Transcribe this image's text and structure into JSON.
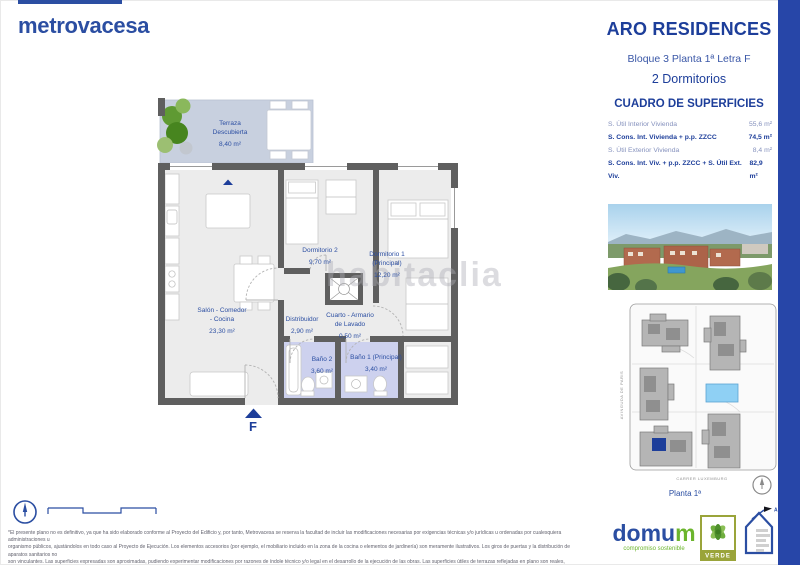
{
  "brand": {
    "name": "metrovacesa"
  },
  "header": {
    "title": "ARO RESIDENCES",
    "block_line": "Bloque 3 Planta 1ª Letra F",
    "type_line": "2 Dormitorios"
  },
  "surfaces": {
    "title": "CUADRO DE SUPERFICIES",
    "rows": [
      {
        "label": "S. Útil Interior Vivienda",
        "value": "55,6 m²"
      },
      {
        "label": "S. Cons. Int. Vivienda + p.p. ZZCC",
        "value": "74,5 m²"
      },
      {
        "label": "S. Útil Exterior Vivienda",
        "value": "8,4 m²"
      },
      {
        "label": "S. Cons. Int. Viv. + p.p. ZZCC + S. Útil Ext. Viv.",
        "value": "82,9 m²"
      }
    ]
  },
  "floorplan": {
    "watermark": "habitaclia",
    "entrance_label": "F",
    "rooms": [
      {
        "line1": "Terraza",
        "line2": "Descubierta",
        "area": "8,40 m²"
      },
      {
        "line1": "Salón - Comedor",
        "line2": "- Cocina",
        "area": "23,30 m²"
      },
      {
        "line1": "Dormitorio 2",
        "area": "9,70 m²"
      },
      {
        "line1": "Dormitorio 1",
        "line2": "(Principal)",
        "area": "12,20 m²"
      },
      {
        "line1": "Distribuidor",
        "area": "2,90 m²"
      },
      {
        "line1": "Cuarto - Armario",
        "line2": "de Lavado",
        "area": "0,50 m²"
      },
      {
        "line1": "Baño 2",
        "area": "3,60 m²"
      },
      {
        "line1": "Baño 1 (Principal)",
        "area": "3,40 m²"
      }
    ]
  },
  "siteplan": {
    "street_left": "AVINGUDA DE PARIS",
    "street_bottom": "CARRER LUXEMBURG",
    "caption": "Planta 1ª"
  },
  "footer": {
    "disclaimer_lines": [
      "*El presente plano no es definitivo, ya que ha sido elaborado conforme al Proyecto del Edificio y, por tanto, Metrovacesa se reserva la facultad de incluir las modificaciones necesarias por exigencias técnicas y/o jurídicas u ordenadas por cualesquiera administraciones u",
      "organismo públicos, ajustándolos en todo caso al Proyecto de Ejecución. Los elementos accesorios (por ejemplo, el mobiliario incluido en la zona de la cocina o elementos de jardinería) son meramente ilustrativos. Los giros de puertas y la distribución de aparatos sanitarios no",
      "son vinculantes. Las superficies expresadas son aproximadas, pudiendo experimentar modificaciones por razones de índole técnico y/o legal en el desarrollo de la ejecución de las obras. Las superficies útiles de terrazas reflejadas en plano son reales, computan en la superficie",
      "útil total de VP (Calificación Provisional) según normativa vigente. La clasificación final de los sellos de sostenibilidad se obtendrán tras el desarrollo del Proyecto de Ejecución.*"
    ],
    "domum": {
      "name_main": "domu",
      "name_accent": "m",
      "tagline": "compromiso sostenible"
    },
    "verde": {
      "label": "VERDE"
    },
    "energy": {
      "rating": "A"
    }
  },
  "colors": {
    "brand_blue": "#2b4ea2",
    "navy": "#1d3e9a",
    "sidebar_blue": "#2746a8",
    "green": "#6cb52d",
    "olive": "#9aa43a",
    "wall_gray": "#5f5f5f",
    "terrace_fill": "#c8d0df",
    "bath_fill": "#cdd1ee",
    "pool_blue": "#8fd0f4"
  }
}
